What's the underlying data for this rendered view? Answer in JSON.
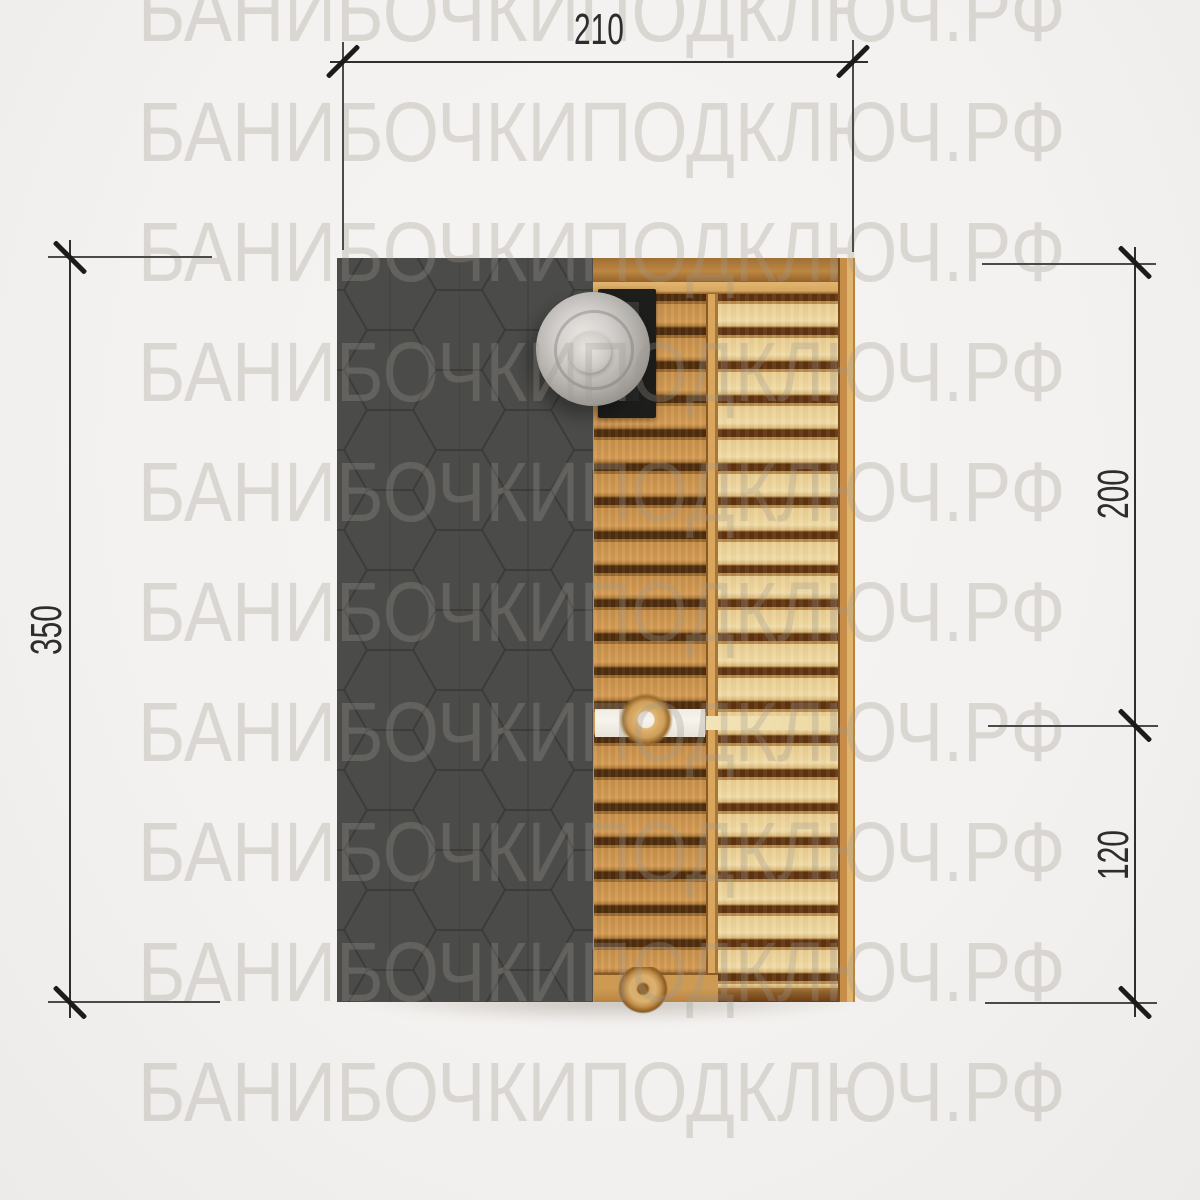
{
  "page": {
    "background_color": "#f4f2f0",
    "description": "Technical top-view plan drawing of a rectangular barrel sauna: shingled roof section on the left, wooden interior (floor boards, bench boards, stove with round chimney, partition with door handles) on the right, with architectural dimension lines."
  },
  "watermark": {
    "text": "БАНИБОЧКИПОДКЛЮЧ.РФ",
    "color": "rgba(160,152,144,0.30)",
    "rows": 10
  },
  "dimensions": {
    "top_width": "210",
    "left_length": "350",
    "right_steam_room": "200",
    "right_entry": "120"
  },
  "colors": {
    "roof_shingles": "#4a4a48",
    "wood_floor": "#c68f49",
    "wood_bench": "#ebd094",
    "frame_wood": "#bd8742",
    "partition_white": "#f4f1eb",
    "stove": "#1d1d1b",
    "chimney_metal": "#c6c2be",
    "dimension_line": "#2f2f2f"
  }
}
